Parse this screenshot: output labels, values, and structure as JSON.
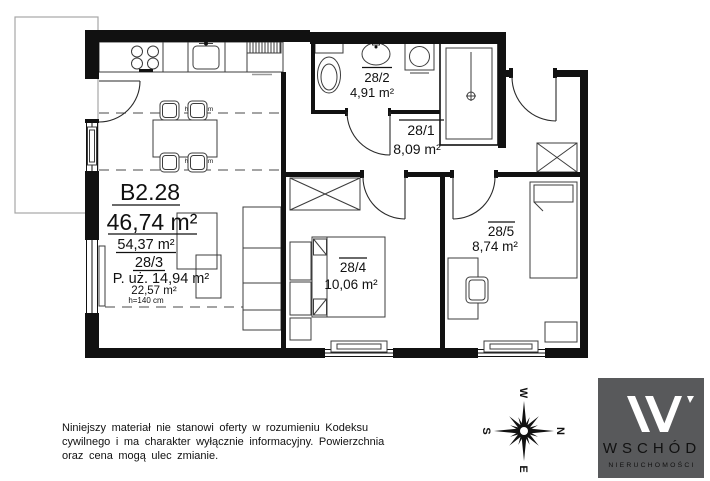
{
  "plan": {
    "unit": {
      "label": "B2.28",
      "area": "46,74 m²",
      "area_secondary": "54,37 m²"
    },
    "living_room": {
      "number": "28/3",
      "usable": "P. uż. 14,94 m²",
      "area_low": "22,57 m²",
      "height": "h=140 cm"
    },
    "bathroom": {
      "number": "28/2",
      "area": "4,91 m²"
    },
    "hallway": {
      "number": "28/1",
      "area": "8,09 m²"
    },
    "bedroom_1": {
      "number": "28/4",
      "area": "10,06 m²"
    },
    "bedroom_2": {
      "number": "28/5",
      "area": "8,74 m²"
    },
    "height_marks": {
      "upper": "h=220 cm",
      "lower": "h=220 cm"
    }
  },
  "compass": {
    "n": "N",
    "e": "E",
    "s": "S",
    "w": "W"
  },
  "disclaimer": {
    "line1": "Niniejszy materiał nie stanowi oferty w rozumieniu Kodeksu",
    "line2": "cywilnego i ma charakter wyłącznie informacyjny. Powierzchnia",
    "line3": "oraz cena mogą ulec zmianie."
  },
  "logo": {
    "brand": "WSCHÓD",
    "tagline": "NIERUCHOMOŚCI",
    "bg_color": "#58595b"
  }
}
